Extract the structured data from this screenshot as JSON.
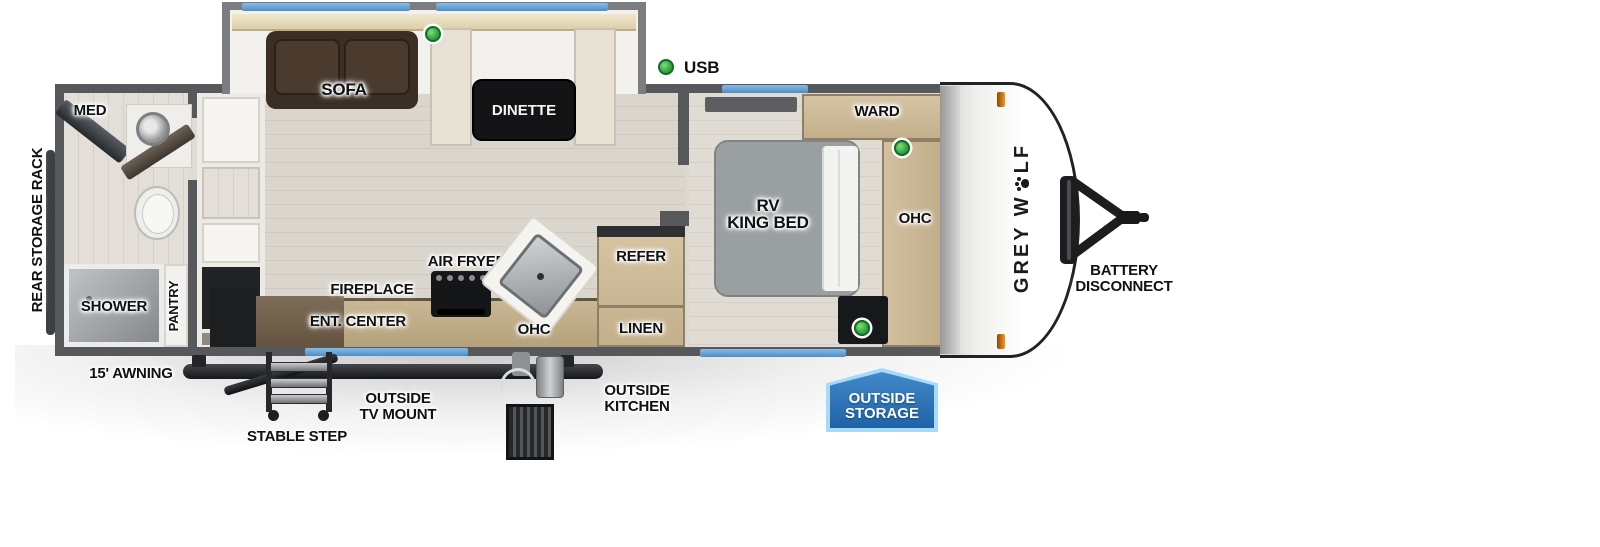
{
  "legend": {
    "usb": "USB"
  },
  "interior": {
    "sofa": "SOFA",
    "dinette": "DINETTE",
    "med": "MED",
    "shower": "SHOWER",
    "pantry": "PANTRY",
    "fireplace": "FIREPLACE",
    "ent_center": "ENT. CENTER",
    "air_fryer": "AIR FRYER",
    "ohc_kitchen": "OHC",
    "refer": "REFER",
    "linen": "LINEN",
    "bed_line1": "RV",
    "bed_line2": "KING BED",
    "ward": "WARD",
    "ohc_bedroom": "OHC"
  },
  "exterior": {
    "rear_storage_rack": "REAR STORAGE RACK",
    "awning": "15' AWNING",
    "stable_step": "STABLE STEP",
    "tv_mount_line1": "OUTSIDE",
    "tv_mount_line2": "TV MOUNT",
    "outside_kitchen_line1": "OUTSIDE",
    "outside_kitchen_line2": "KITCHEN",
    "storage_badge_line1": "OUTSIDE",
    "storage_badge_line2": "STORAGE",
    "battery_line1": "BATTERY",
    "battery_line2": "DISCONNECT"
  },
  "brand": {
    "part1": "GREY W",
    "part2": "LF"
  },
  "colors": {
    "accent_blue": "#5b9bd5",
    "storage_badge_blue": "#2b74b8",
    "storage_badge_border": "#a7daf6",
    "usb_green": "#35ac46",
    "marker_orange": "#f7941d",
    "wall_gray": "#57585c",
    "cabinet_tan": "#c9b697",
    "sofa_brown": "#3a2e25",
    "bed_gray": "#9aa0a2",
    "floor_light": "#dad5cd"
  }
}
